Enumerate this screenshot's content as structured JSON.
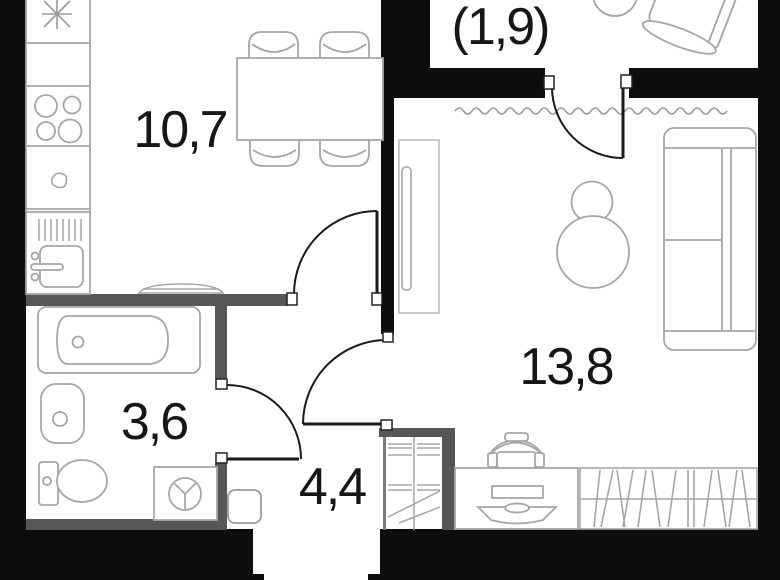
{
  "rooms": [
    {
      "id": "kitchen-living",
      "area_label": "10,7"
    },
    {
      "id": "balcony",
      "area_label": "(1,9)"
    },
    {
      "id": "living-room",
      "area_label": "13,8"
    },
    {
      "id": "bathroom",
      "area_label": "3,6"
    },
    {
      "id": "hallway",
      "area_label": "4,4"
    }
  ],
  "colors": {
    "wall_exterior": "#0d0d0d",
    "wall_partition": "#575757",
    "furniture_line": "#a6a6a6",
    "door_line": "#1a1a1a",
    "label_text": "#161616",
    "background": "#ffffff"
  },
  "icons": [
    "fridge-snowflake-icon",
    "hob-burners-icon",
    "sink-icon",
    "washing-machine-icon",
    "door-swing-arc-icon",
    "window-wave-icon"
  ]
}
